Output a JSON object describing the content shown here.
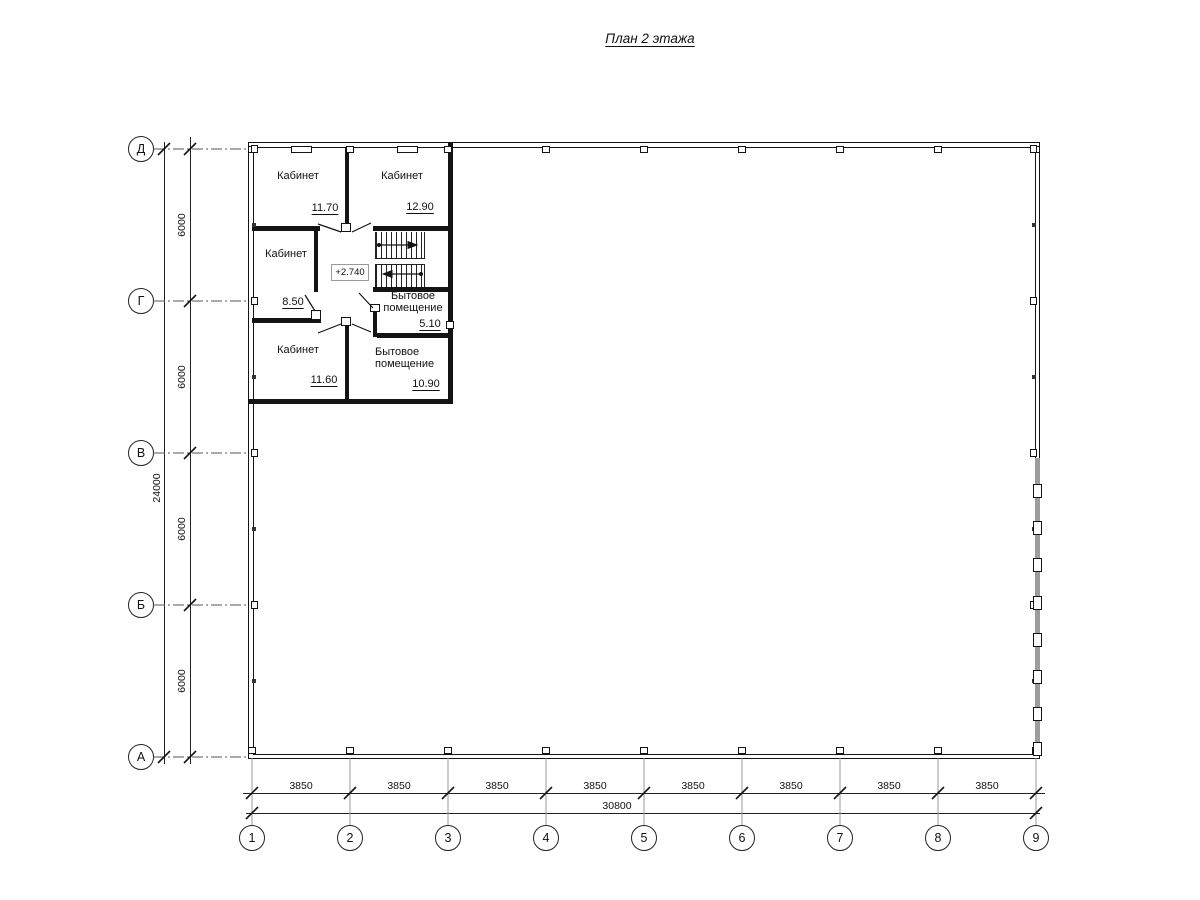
{
  "title": "План 2 этажа",
  "level_mark": "+2.740",
  "rooms": [
    {
      "name": "Кабинет",
      "area": "11.70"
    },
    {
      "name": "Кабинет",
      "area": "12.90"
    },
    {
      "name": "Кабинет",
      "area": "8.50"
    },
    {
      "name": "Кабинет",
      "area": "11.60"
    },
    {
      "name": "Бытовое помещение",
      "area": "5.10"
    },
    {
      "name": "Бытовое помещение",
      "area": "10.90"
    }
  ],
  "axes": {
    "rows": [
      "Д",
      "Г",
      "В",
      "Б",
      "А"
    ],
    "columns": [
      "1",
      "2",
      "3",
      "4",
      "5",
      "6",
      "7",
      "8",
      "9"
    ]
  },
  "dims": {
    "bottom_segments": [
      "3850",
      "3850",
      "3850",
      "3850",
      "3850",
      "3850",
      "3850",
      "3850"
    ],
    "bottom_total": "30800",
    "left_segments": [
      "6000",
      "6000",
      "6000",
      "6000"
    ],
    "left_total": "24000"
  },
  "colors": {
    "line": "#141414",
    "wall_fill": "#9c9c9c",
    "grid": "#999999"
  }
}
